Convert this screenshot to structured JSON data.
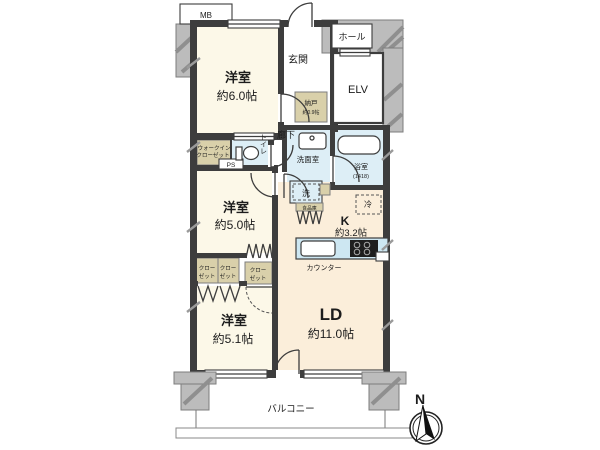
{
  "plan": {
    "type": "apartment-floor-plan",
    "rooms": {
      "bedroom1": {
        "name": "洋室",
        "size": "約6.0帖"
      },
      "bedroom2": {
        "name": "洋室",
        "size": "約5.0帖"
      },
      "bedroom3": {
        "name": "洋室",
        "size": "約5.1帖"
      },
      "living_dining": {
        "name": "LD",
        "size": "約11.0帖"
      },
      "kitchen": {
        "name": "K",
        "size": "約3.2帖"
      },
      "storage_room": {
        "name": "納戸",
        "size": "約0.9帖"
      },
      "entrance": {
        "label": "玄関"
      },
      "corridor": {
        "label": "廊下"
      },
      "hall": {
        "label": "ホール"
      },
      "elevator": {
        "label": "ELV"
      },
      "toilet": {
        "label": "トイレ"
      },
      "washroom": {
        "label": "洗面室"
      },
      "bathroom": {
        "label": "浴室",
        "size_code": "(1418)"
      },
      "washer": {
        "label": "洗"
      },
      "refrigerator": {
        "label": "冷"
      },
      "pantry": {
        "label": "食品庫"
      },
      "walk_in_closet": {
        "line1": "ウォークイン",
        "line2": "クローゼット"
      },
      "closet": {
        "line1": "クロー",
        "line2": "ゼット"
      },
      "counter": {
        "label": "カウンター"
      },
      "balcony": {
        "label": "バルコニー"
      },
      "meter_box": {
        "label": "MB"
      },
      "pipe_space": {
        "label": "PS"
      },
      "compass_north": {
        "label": "N"
      }
    },
    "colors": {
      "cream": "#fcf8e8",
      "peach": "#fbeeda",
      "blue": "#ddeef6",
      "tan": "#d9d0aa",
      "gray": "#bcbcbc",
      "wall": "#3d3d3d",
      "hatch": "#8f8f8f",
      "counter_blue": "#cde7f2"
    }
  }
}
